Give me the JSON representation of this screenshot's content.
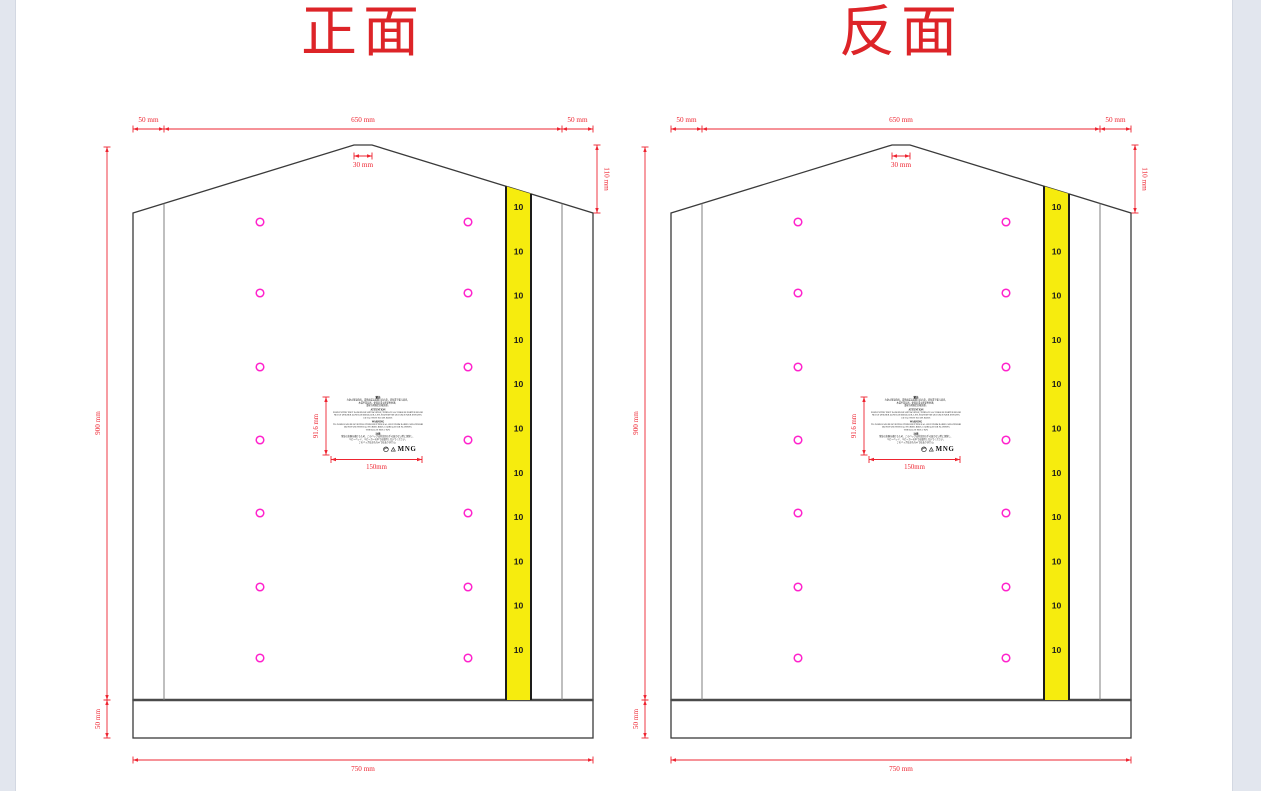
{
  "page": {
    "background": "#ffffff",
    "gutter_color": "#e2e6ee"
  },
  "diagrams": [
    {
      "id": "front",
      "title": "正面"
    },
    {
      "id": "back",
      "title": "反面"
    }
  ],
  "dimensions": {
    "top_left": "50 mm",
    "top_center": "650 mm",
    "top_right": "50 mm",
    "peak": "30 mm",
    "right_side": "110 mm",
    "left_side": "900 mm",
    "bottom_left_side": "50 mm",
    "bottom": "750 mm",
    "care_label_height": "91.6 mm",
    "care_label_width": "150mm"
  },
  "tape": {
    "label": "10",
    "count": 11
  },
  "punch_holes": {
    "columns": 2,
    "rows": 7
  },
  "care_label": {
    "sections": [
      {
        "heading": "警告",
        "lines": [
          "为防止窒息危险，请将此袋远离婴儿和儿童，切勿置于婴儿床内，",
          "本袋不是玩具，使用后请立即妥善处理，",
          "请按当地规定回收处理。"
        ]
      },
      {
        "heading": "ATTENTION",
        "lines": [
          "POUR EVITER TOUT DANGER DE SUFFOCATION, TENIR CE SAC HORS DE PORTEE DES BEBES,",
          "NE PAS UTILISER DANS LES BERCEAUX, LITS, POUSSETTES OU PARCS POUR ENFANTS,",
          "CE SAC N'EST PAS UN JOUET."
        ]
      },
      {
        "heading": "WARNING",
        "lines": [
          "TO AVOID DANGER OF SUFFOCATION KEEP THIS BAG AWAY FROM BABIES AND CHILDREN,",
          "DO NOT USE THIS BAG IN CRIBS, BEDS, CARRIAGES OR PLAYPENS,",
          "THIS BAG IS NOT A TOY."
        ]
      },
      {
        "heading": "注意",
        "lines": [
          "窒息の危険を避けるため、このバッグは乳幼児の手の届かない所に保管し、",
          "ベビーベッド、ベビーカーの中では使用しないでください，",
          "このバッグはおもちゃではありません。"
        ]
      }
    ],
    "brand": "MNG",
    "icons": [
      "green-dot-icon",
      "recycling-icon"
    ]
  },
  "colors": {
    "dimension": "#ee2430",
    "title": "#dd2428",
    "outline": "#3a3a3a",
    "fold_line": "#7f7f7f",
    "hole": "#ff22cc",
    "tape_fill": "#f6ec0e",
    "tape_border": "#1d1d1b",
    "tape_text": "#1a1a1a"
  }
}
